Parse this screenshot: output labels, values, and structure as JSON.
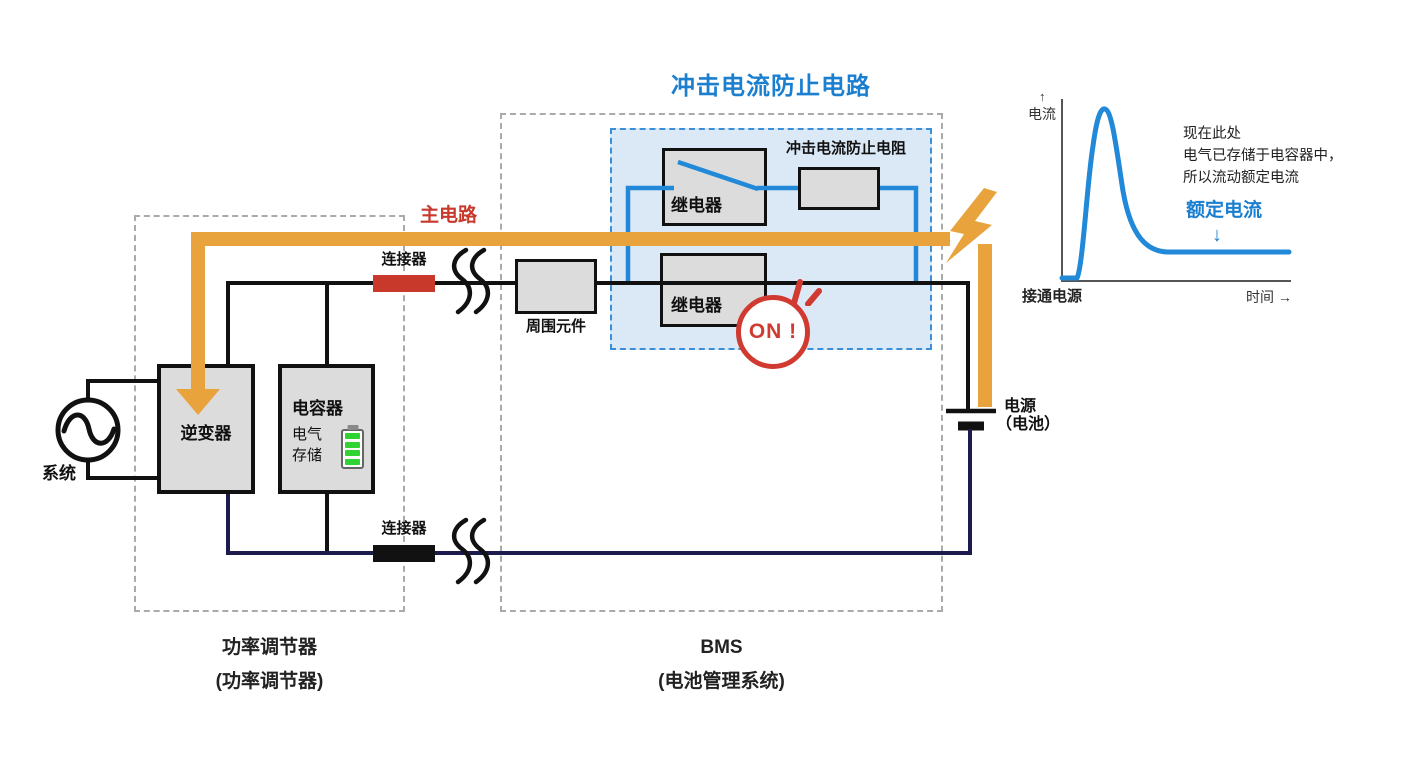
{
  "colors": {
    "accent_blue": "#1b7fd0",
    "wire_blue": "#2288d8",
    "inrush_fill": "#dbe9f7",
    "orange": "#e8a33c",
    "red": "#c8392c",
    "component_fill": "#dcdcdc",
    "wire_black": "#111111",
    "wire_navy": "#1b1b4e",
    "dash_gray": "#aaaaaa",
    "battery_green": "#2fd332"
  },
  "icons": {
    "lightning": "lightning-bolt",
    "ac_source": "sine-wave-in-circle",
    "battery_gauge": "green-battery-level",
    "wire_break": "double-squiggle-break",
    "spark": "emphasis-spark-marks",
    "flow_arrow": "thick-orange-down-arrow"
  },
  "inrush": {
    "title": "冲击电流防止电路",
    "resistor_label": "冲击电流防止电阻",
    "relay_top_label": "继电器",
    "relay_bottom_label": "继电器",
    "on_badge": "ON !"
  },
  "main": {
    "main_circuit_label": "主电路",
    "connector_top_label": "连接器",
    "connector_bottom_label": "连接器",
    "peripheral_label": "周围元件"
  },
  "pcs": {
    "inverter_label": "逆变器",
    "capacitor_label": "电容器",
    "storage_line1": "电气",
    "storage_line2": "存储",
    "system_label": "系统",
    "caption_line1": "功率调节器",
    "caption_line2": "(功率调节器)"
  },
  "bms": {
    "caption_line1": "BMS",
    "caption_line2": "(电池管理系统)"
  },
  "battery": {
    "label_line1": "电源",
    "label_line2": "（电池）"
  },
  "graph": {
    "y_arrow": "↑",
    "ylabel": "电流",
    "xlabel": "时间 →",
    "origin_label": "接通电源",
    "note_line1": "现在此处",
    "note_line2": "电气已存储于电容器中，",
    "note_line3": "所以流动额定电流",
    "rated_label": "额定电流",
    "rated_arrow": "↓"
  },
  "chart_data": {
    "type": "line",
    "title": "",
    "xlabel": "时间",
    "ylabel": "电流",
    "x_axis_note": "接通电源 (t=0)",
    "legend_position": "none",
    "grid": false,
    "series": [
      {
        "name": "电流",
        "x": [
          0,
          6,
          9,
          13,
          17,
          22,
          28,
          35,
          45,
          60,
          100
        ],
        "y": [
          0,
          0,
          45,
          98,
          80,
          40,
          18,
          17,
          17,
          17,
          17
        ]
      }
    ],
    "ylim": [
      0,
      100
    ],
    "annotations": [
      {
        "text": "现在此处 电气已存储于电容器中，所以流动额定电流",
        "target": "settled flat region"
      },
      {
        "text": "额定电流",
        "target": "flat steady-state level ≈17"
      }
    ]
  }
}
